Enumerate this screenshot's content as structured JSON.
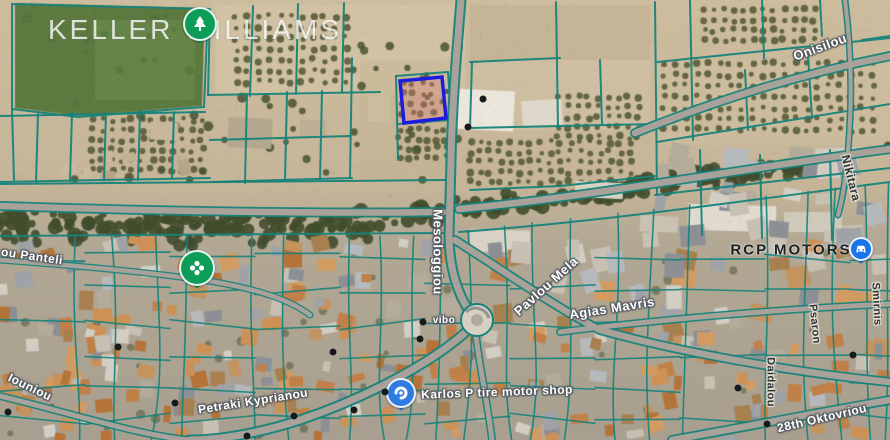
{
  "watermark": {
    "text": "KELLER WILLIAMS"
  },
  "colors": {
    "parcel_line": "#17837a",
    "road_fill": "#a8a29a",
    "highlight_stroke": "#1c1ce0",
    "highlight_fill": "rgba(226,128,118,0.33)",
    "pin_green": "#0c9d58",
    "pin_blue": "#1a73e8",
    "shop_blue": "#2e7ce0",
    "roundabout_fill": "#d6d0c3"
  },
  "highlight_parcel": {
    "points": "400,81 442,77 446,118 404,123"
  },
  "labels": [
    {
      "name": "road-label-onisilou",
      "text": "Onisilou",
      "x": 820,
      "y": 47,
      "rot": -20,
      "style": "road",
      "size": 13
    },
    {
      "name": "road-label-mesologgiou",
      "text": "Mesologgiou",
      "x": 438,
      "y": 252,
      "rot": 90,
      "style": "road",
      "size": 13
    },
    {
      "name": "road-label-pavlou-mela",
      "text": "Pavlou Mela",
      "x": 546,
      "y": 286,
      "rot": -42,
      "style": "road",
      "size": 13
    },
    {
      "name": "road-label-agias-mavris",
      "text": "Agias Mavris",
      "x": 612,
      "y": 308,
      "rot": -9,
      "style": "road",
      "size": 13
    },
    {
      "name": "poi-label-rcp-motors",
      "text": "RCP MOTORS",
      "x": 791,
      "y": 250,
      "rot": 0,
      "style": "poi",
      "size": 15
    },
    {
      "name": "street-label-nikitara",
      "text": "Nikitara",
      "x": 851,
      "y": 178,
      "rot": 76,
      "style": "street",
      "size": 12
    },
    {
      "name": "poi-label-karlos-shop",
      "text": "Karlos P tire motor shop",
      "x": 497,
      "y": 392,
      "rot": -2,
      "style": "road",
      "size": 12
    },
    {
      "name": "poi-label-vibo",
      "text": "vibo",
      "x": 444,
      "y": 321,
      "rot": 0,
      "style": "road",
      "size": 10
    },
    {
      "name": "road-label-petraki",
      "text": "Petraki Kyprianou",
      "x": 253,
      "y": 401,
      "rot": -9,
      "style": "road",
      "size": 12
    },
    {
      "name": "road-label-panteli",
      "text": "ou Panteli",
      "x": 32,
      "y": 256,
      "rot": 8,
      "style": "road",
      "size": 12
    },
    {
      "name": "road-label-iouniou",
      "text": "Iouniou",
      "x": 30,
      "y": 387,
      "rot": 26,
      "style": "road",
      "size": 12
    },
    {
      "name": "road-label-28th-oktovriou",
      "text": "28th Oktovriou",
      "x": 822,
      "y": 418,
      "rot": -13,
      "style": "road",
      "size": 12
    },
    {
      "name": "street-label-daidalou",
      "text": "Daidalou",
      "x": 770,
      "y": 382,
      "rot": 90,
      "style": "street",
      "size": 11
    },
    {
      "name": "street-label-psaron",
      "text": "Psaron",
      "x": 814,
      "y": 324,
      "rot": 84,
      "style": "street",
      "size": 11
    },
    {
      "name": "street-label-smirnis",
      "text": "Smirnis",
      "x": 876,
      "y": 304,
      "rot": 87,
      "style": "street",
      "size": 11
    }
  ],
  "markers": [
    {
      "name": "park-tree-pin",
      "type": "tree",
      "x": 200,
      "y": 24,
      "color": "#0c9d58"
    },
    {
      "name": "garden-flower-pin",
      "type": "flower",
      "x": 197,
      "y": 268,
      "color": "#0c9d58"
    },
    {
      "name": "car-service-poi",
      "type": "car",
      "x": 861,
      "y": 249,
      "color": "#1a73e8"
    },
    {
      "name": "tire-shop-pin",
      "type": "shop",
      "x": 401,
      "y": 393,
      "color": "#2e7ce0"
    }
  ],
  "poi_dots": [
    [
      483,
      99
    ],
    [
      468,
      127
    ],
    [
      333,
      352
    ],
    [
      423,
      322
    ],
    [
      420,
      339
    ],
    [
      175,
      403
    ],
    [
      294,
      416
    ],
    [
      385,
      392
    ],
    [
      738,
      388
    ],
    [
      767,
      424
    ],
    [
      853,
      355
    ],
    [
      118,
      347
    ],
    [
      247,
      436
    ],
    [
      8,
      412
    ],
    [
      354,
      410
    ]
  ]
}
